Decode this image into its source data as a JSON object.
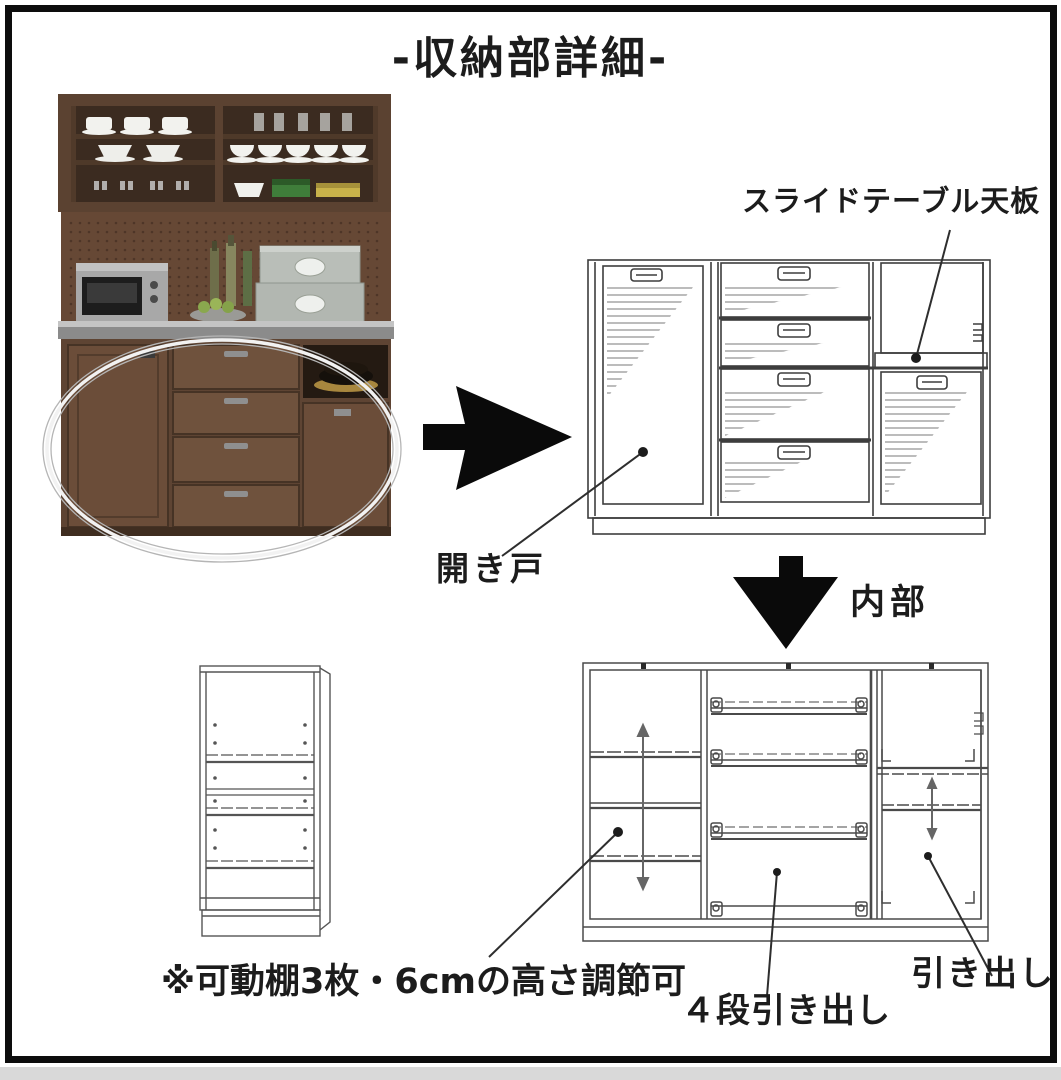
{
  "title": "-収納部詳細-",
  "annotations": {
    "slide_table": "スライドテーブル天板",
    "open_door": "開き戸",
    "interior": "内部",
    "shelf_note": "※可動棚3枚・6cmの高さ調節可",
    "four_tier_drawers": "４段引き出し",
    "drawer": "引き出し"
  },
  "icons": {
    "right_arrow": "black solid right-pointing arrow",
    "down_arrow": "black solid down-pointing arrow",
    "highlight_ellipse": "silver oval highlighting lower storage section"
  },
  "colors": {
    "frame_border": "#0d0d0d",
    "background": "#ffffff",
    "text": "#1c1c1c",
    "line_art": "#3d3d3d",
    "arrow": "#0a0a0a",
    "wood_dark": "#5b4231",
    "wood_mid": "#6e4f3a",
    "counter_gray": "#8b8b8b",
    "outside_strip": "#d9d9d9"
  }
}
